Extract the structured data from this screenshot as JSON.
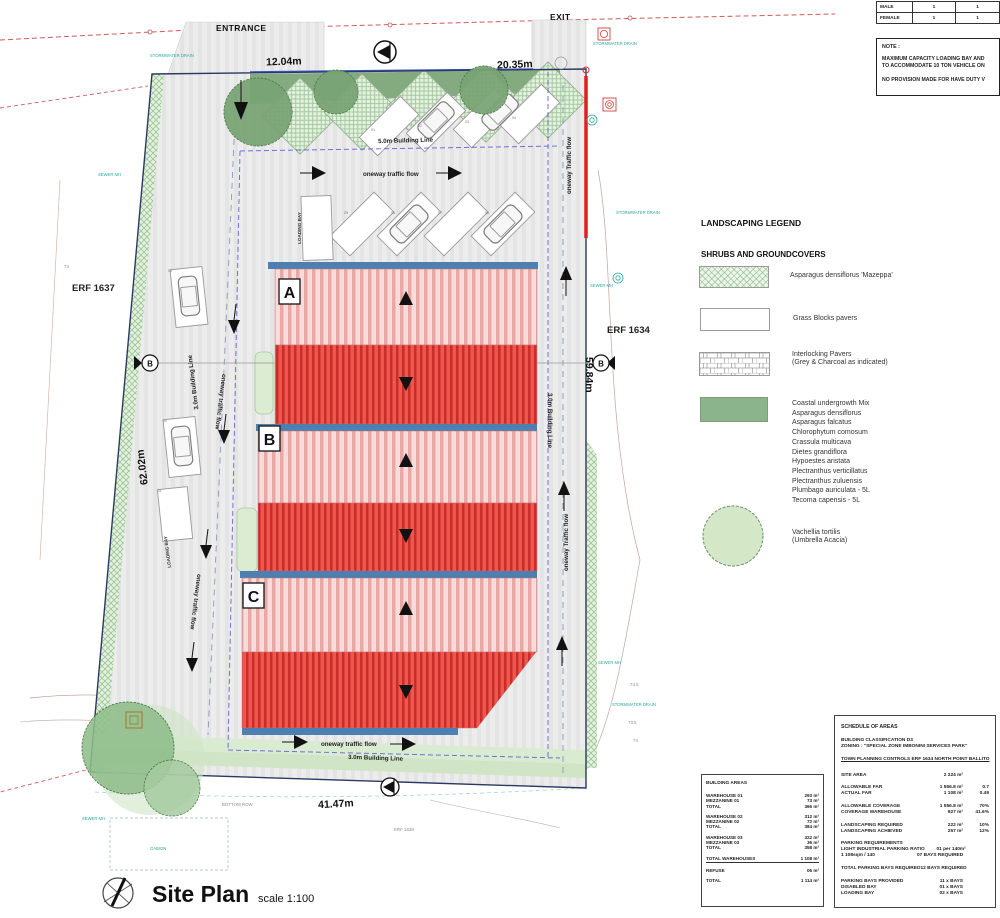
{
  "plan": {
    "entrance": "ENTRANCE",
    "exit": "EXIT",
    "dim_top_left": "12.04m",
    "dim_top_right": "20.35m",
    "dim_left": "62.02m",
    "dim_right": "59.84m",
    "dim_bottom": "41.47m",
    "erf_left": "ERF 1637",
    "erf_right": "ERF 1634",
    "erf_bottom": "ERF 1638",
    "bl_top": "5.0m Building Line",
    "bl_left": "3.0m Building Line",
    "bl_right": "3.0m Building Line",
    "bl_bottom": "3.0m Building Line",
    "flow_top": "oneway traffic flow",
    "flow_left": "oneway traffic flow",
    "flow_right": "oneway Traffic flow",
    "flow_bottom": "oneway traffic flow",
    "loading_bay": "LOADING BAY",
    "building_a": "A",
    "building_b": "B",
    "building_c": "C",
    "section_marker": "B",
    "gabion": "GABION",
    "bottom_row": "BOTTOM ROW",
    "ann_sewer": "SEWER MH",
    "ann_stormwater": "STORMWATER DRAIN",
    "bays": [
      "01",
      "02",
      "03",
      "04",
      "05",
      "06",
      "07",
      "08",
      "09",
      "10",
      "11"
    ],
    "contours": [
      "74.5",
      "74",
      "73.5"
    ]
  },
  "title_block": {
    "title": "Site Plan",
    "scale": "scale 1:100"
  },
  "occupancy": {
    "rows": [
      {
        "label": "MALE",
        "c1": "1",
        "c2": "1"
      },
      {
        "label": "FEMALE",
        "c1": "1",
        "c2": "1"
      }
    ]
  },
  "note": {
    "heading": "NOTE :",
    "lines": [
      "MAXIMUM CAPACITY LOADING BAY AND",
      "TO ACCOMMODATE 10 TON VEHICLE ON",
      "NO PROVISION MADE FOR HAVE DUTY V"
    ]
  },
  "legend": {
    "title": "LANDSCAPING LEGEND",
    "subtitle": "SHRUBS AND GROUNDCOVERS",
    "item1": "Asparagus densiflorus 'Mazeppa'",
    "item2": "Grass Blocks pavers",
    "item3a": "Interlocking Pavers",
    "item3b": "(Grey & Charcoal as indicated)",
    "mix": [
      "Coastal undergrowth Mix",
      "Asparagus densiflorus",
      "Asparagus falcatus",
      "Chlorophytum comosum",
      "Crassula multicava",
      "Dietes grandiflora",
      "Hypoestes aristata",
      "Plectranthus verticillatus",
      "Plectranthus zuluensis",
      "Plumbago auriculata - 5L",
      "Tecoma capensis - 5L"
    ],
    "tree_a": "Vachellia tortilis",
    "tree_b": "(Umbrella Acacia)"
  },
  "schedule": {
    "title": "SCHEDULE OF AREAS",
    "class_line": "BUILDING CLASSIFICATION D3",
    "zoning_line": "ZONING : \"SPECIAL ZONE IMBONINI SERVICES PARK\"",
    "controls_line": "TOWN PLANNING CONTROLS ERF 1634 NORTH POINT BALLITO",
    "rows": [
      {
        "label": "SITE AREA",
        "v1": "2 224 m²",
        "v2": "",
        "gap": true
      },
      {
        "label": "ALLOWABLE FAR",
        "v1": "1 556.8 m²",
        "v2": "0.7",
        "gap": true
      },
      {
        "label": "ACTUAL FAR",
        "v1": "1 108 m²",
        "v2": "0.49"
      },
      {
        "label": "ALLOWABLE COVERAGE",
        "v1": "1 556.8 m²",
        "v2": "70%",
        "gap": true
      },
      {
        "label": "COVERAGE WAREHOUSE",
        "v1": "927 m²",
        "v2": "41.6%"
      },
      {
        "label": "LANDSCAPING REQUIRED",
        "v1": "222 m²",
        "v2": "10%",
        "gap": true
      },
      {
        "label": "LANDSCAPING ACHIEVED",
        "v1": "257 m²",
        "v2": "12%"
      },
      {
        "label": "PARKING REQUIREMENTS",
        "v1": "",
        "v2": "",
        "gap": true
      },
      {
        "label": "LIGHT INDUSTRIAL PARKING RATIO",
        "v1": "01 per 140m²",
        "v2": ""
      },
      {
        "label": "1 108sqm / 140",
        "v1": "07 BAYS REQUIRED",
        "v2": ""
      },
      {
        "label": "TOTAL PARKING BAYS REQUIRED",
        "v1": "12 BAYS REQUIRED",
        "v2": "",
        "gap": true
      },
      {
        "label": "PARKING BAYS PROVIDED",
        "v1": "11 x BAYS",
        "v2": "",
        "gap": true
      },
      {
        "label": "DISABLED BAY",
        "v1": "01 x BAYS",
        "v2": ""
      },
      {
        "label": "LOADING BAY",
        "v1": "02 x BAYS",
        "v2": ""
      }
    ]
  },
  "building_areas": {
    "title": "BUILDING AREAS",
    "rows": [
      {
        "label": "WAREHOUSE 01",
        "v": "293  m²",
        "gap": true
      },
      {
        "label": "MEZZANINE 01",
        "v": "73  m²"
      },
      {
        "label": "TOTAL",
        "v": "366  m²"
      },
      {
        "label": "WAREHOUSE 02",
        "v": "312  m²",
        "gap": true
      },
      {
        "label": "MEZZANINE 02",
        "v": "72  m²"
      },
      {
        "label": "TOTAL",
        "v": "384  m²"
      },
      {
        "label": "WAREHOUSE 03",
        "v": "322  m²",
        "gap": true
      },
      {
        "label": "MEZZANINE 03",
        "v": "36  m²"
      },
      {
        "label": "TOTAL",
        "v": "358  m²"
      },
      {
        "label": "TOTAL WAREHOUSES",
        "v": "1 108  m²",
        "gap": true,
        "ul": true
      },
      {
        "label": "REFUSE",
        "v": "06  m²",
        "gap": true
      },
      {
        "label": "TOTAL",
        "v": "1 114  m²",
        "gap": true
      }
    ]
  }
}
